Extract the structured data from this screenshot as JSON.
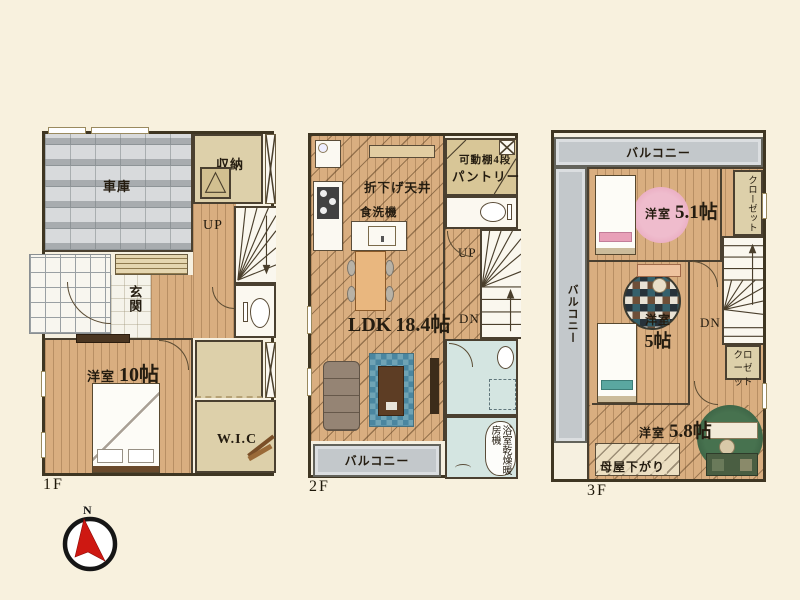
{
  "floor1": {
    "floor_label": "1F",
    "garage": "車庫",
    "storage": "収納",
    "up": "UP",
    "entrance": "玄関",
    "bedroom_type": "洋室",
    "bedroom_size": "10帖",
    "wic": "W.I.C"
  },
  "floor2": {
    "floor_label": "2F",
    "lowered_ceiling": "折下げ天井",
    "dishwasher": "食洗機",
    "movable_shelf": "可動棚4段",
    "pantry": "パントリー",
    "up": "UP",
    "dn": "DN",
    "ldk_type": "LDK",
    "ldk_size": "18.4帖",
    "balcony": "バルコニー",
    "bath_dryer": "浴室乾燥暖房機"
  },
  "floor3": {
    "floor_label": "3F",
    "balcony_top": "バルコニー",
    "balcony_left": "バルコニー",
    "room_a_type": "洋室",
    "room_a_size": "5.1帖",
    "closet_a": "クローゼット",
    "dn": "DN",
    "room_b_type": "洋室",
    "room_b_size": "5帖",
    "closet_b": "クローゼット",
    "room_c_type": "洋室",
    "room_c_size": "5.8帖",
    "moya_sagari": "母屋下がり"
  },
  "compass": {
    "north_label": "N"
  },
  "colors": {
    "background": "#f8f1de",
    "wood_floor": "#d9ae80",
    "wall": "#3f3622",
    "tatami_beige": "#ddd0aa",
    "bath_blue": "#d4e5e1",
    "balcony_gray": "#c3c8cb",
    "compass_red": "#ce1812",
    "pink_rug": "#e8a7bd"
  }
}
